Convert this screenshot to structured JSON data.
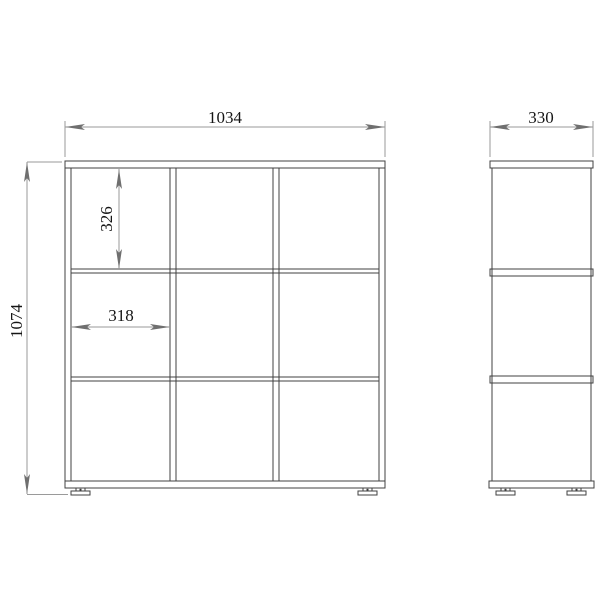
{
  "drawing": {
    "kind": "cube-shelf technical drawing, front and side elevation",
    "colors": {
      "background": "#ffffff",
      "part_line": "#404040",
      "dimension_line": "#9a9a9a",
      "text": "#151515"
    },
    "dimensions": {
      "width": "1034",
      "depth": "330",
      "height": "1074",
      "cell_height": "326",
      "cell_width": "318"
    }
  }
}
